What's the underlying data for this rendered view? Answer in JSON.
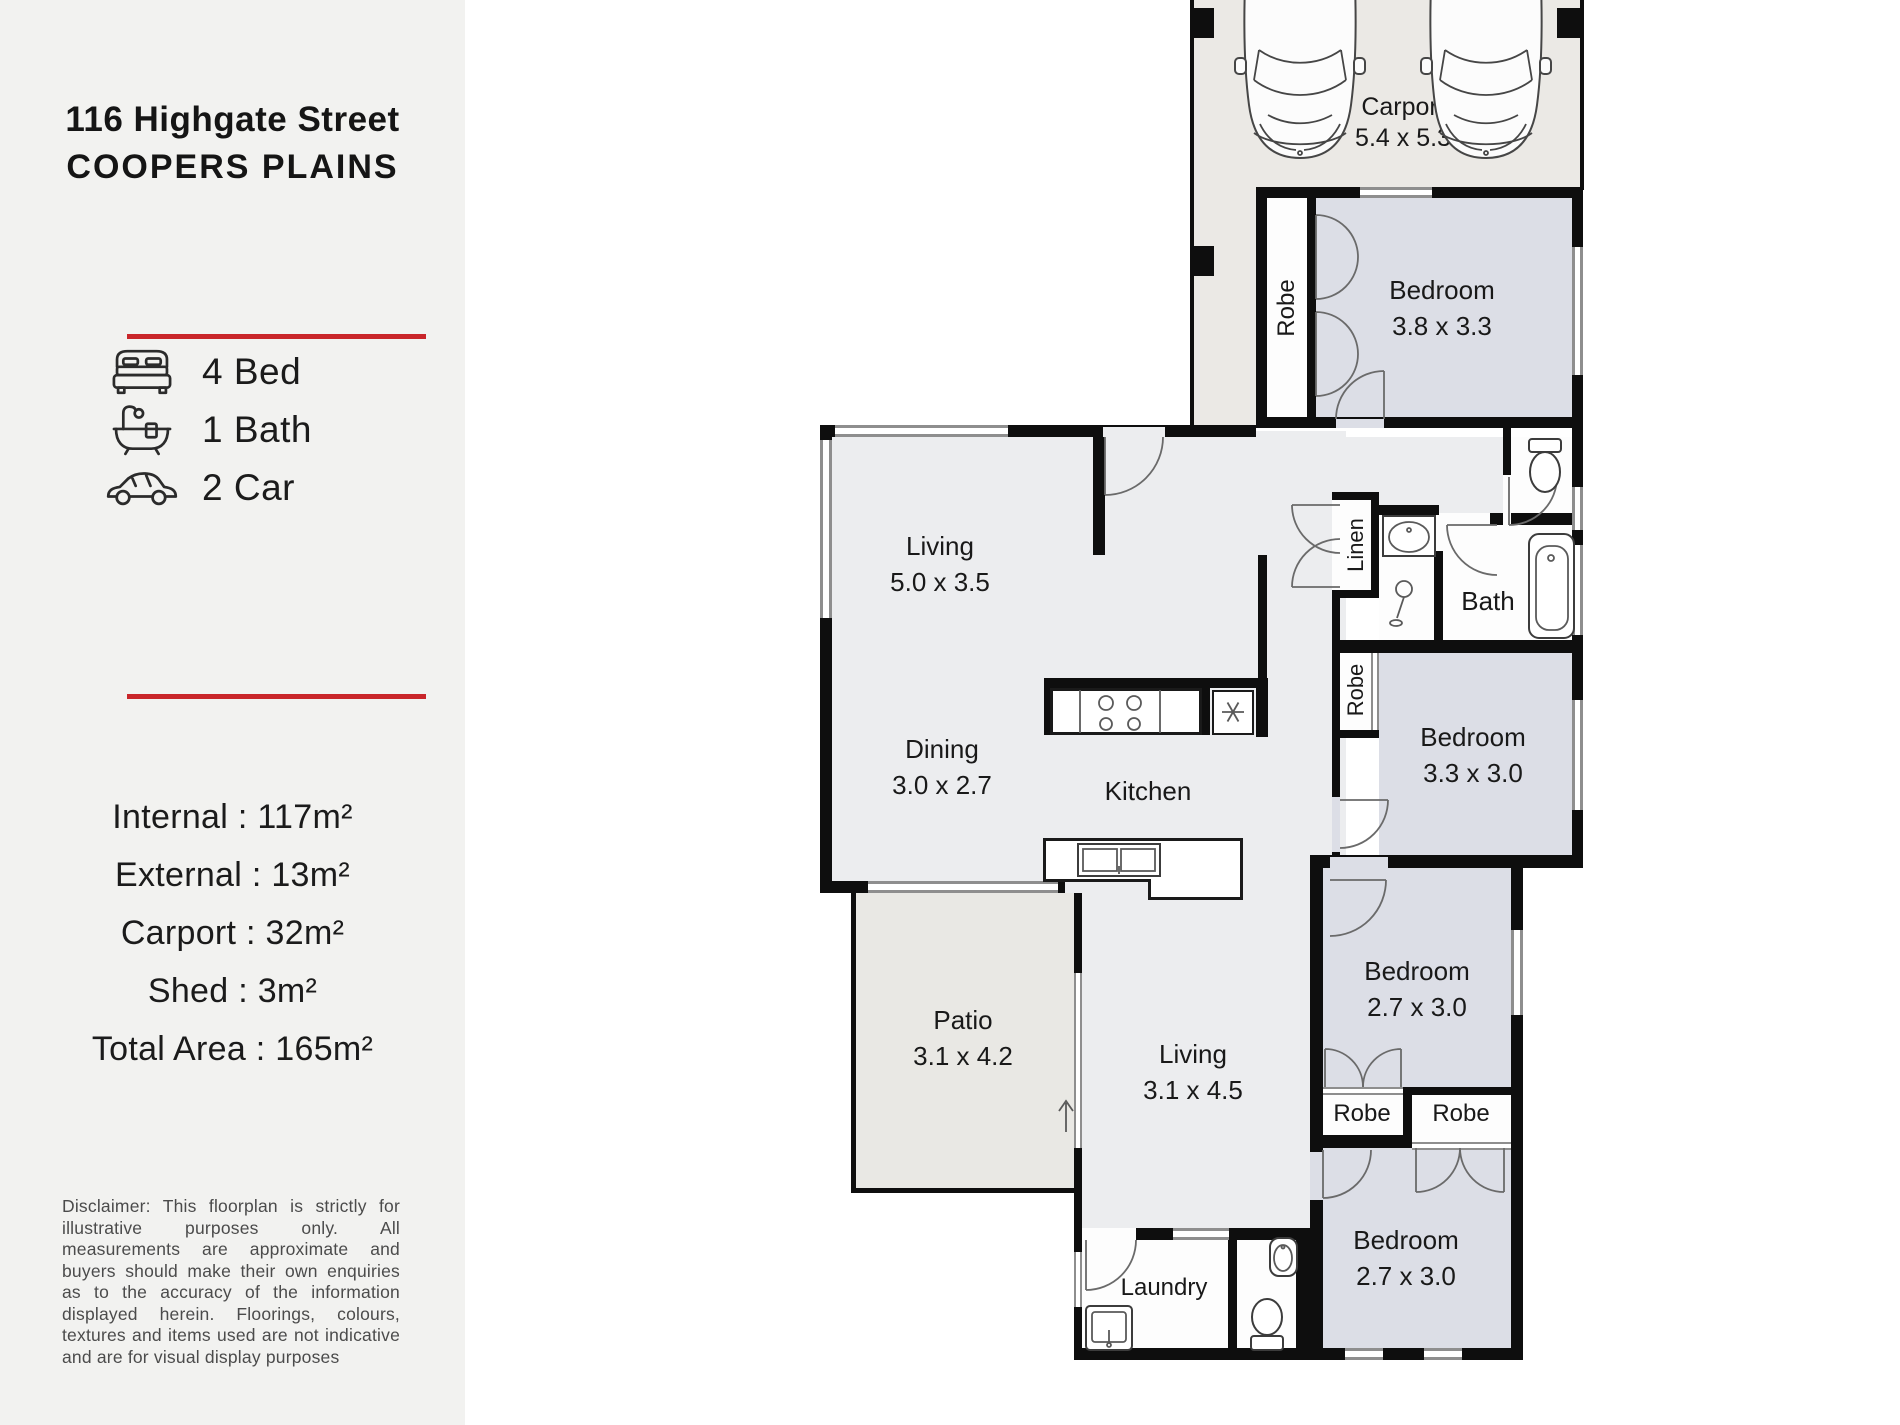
{
  "sidebar": {
    "address_line1": "116 Highgate Street",
    "address_line2": "COOPERS PLAINS",
    "accent_color": "#c9262a",
    "features": {
      "bed": "4 Bed",
      "bath": "1 Bath",
      "car": "2 Car"
    },
    "areas": {
      "internal": "Internal : 117m²",
      "external": "External : 13m²",
      "carport": "Carport : 32m²",
      "shed": "Shed : 3m²",
      "total": "Total Area : 165m²"
    },
    "disclaimer": "Disclaimer: This floorplan is strictly for illustrative purposes only. All measurements are approximate and buyers should make their own enquiries as to the accuracy of the information displayed herein. Floorings, colours, textures and items used are not indicative and are for visual display purposes"
  },
  "floorplan": {
    "rooms": {
      "carport": {
        "label": "Carport",
        "dims": "5.4 x 5.3"
      },
      "bedroom1": {
        "label": "Bedroom",
        "dims": "3.8 x 3.3"
      },
      "living1": {
        "label": "Living",
        "dims": "5.0 x 3.5"
      },
      "dining": {
        "label": "Dining",
        "dims": "3.0 x 2.7"
      },
      "kitchen": {
        "label": "Kitchen"
      },
      "linen": {
        "label": "Linen"
      },
      "bath": {
        "label": "Bath"
      },
      "robe_bed1": {
        "label": "Robe"
      },
      "robe_bed2": {
        "label": "Robe"
      },
      "bedroom2": {
        "label": "Bedroom",
        "dims": "3.3 x 3.0"
      },
      "bedroom3": {
        "label": "Bedroom",
        "dims": "2.7 x 3.0"
      },
      "robe_left": {
        "label": "Robe"
      },
      "robe_right": {
        "label": "Robe"
      },
      "bedroom4": {
        "label": "Bedroom",
        "dims": "2.7 x 3.0"
      },
      "patio": {
        "label": "Patio",
        "dims": "3.1 x 4.2"
      },
      "living2": {
        "label": "Living",
        "dims": "3.1 x 4.5"
      },
      "laundry": {
        "label": "Laundry"
      }
    }
  }
}
